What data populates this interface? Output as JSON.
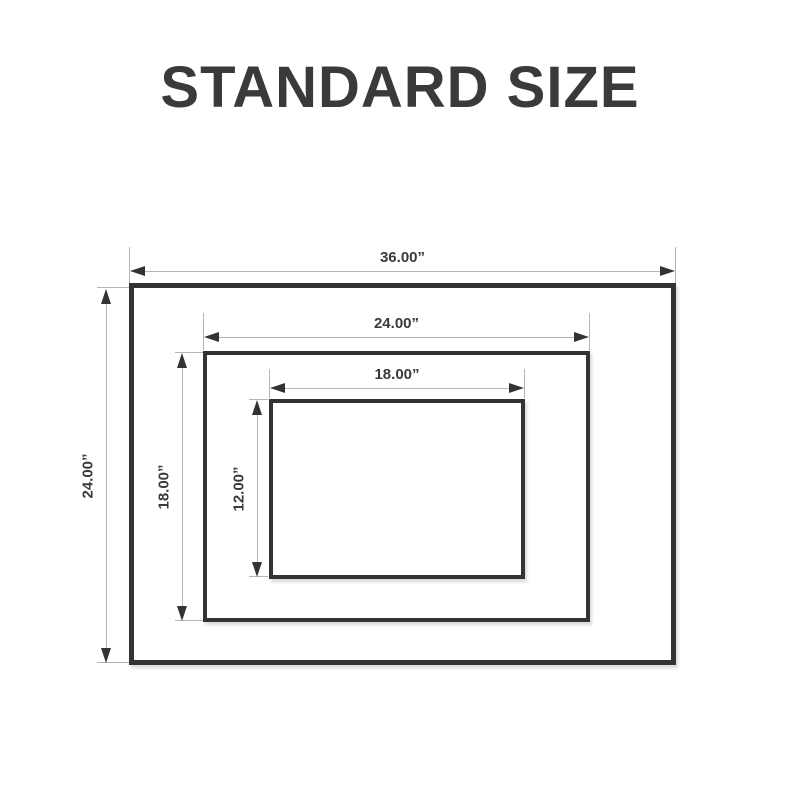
{
  "title": "STANDARD SIZE",
  "diagram": {
    "outer": {
      "width_label": "36.00”",
      "height_label": "24.00”"
    },
    "middle": {
      "width_label": "24.00”",
      "height_label": "18.00”"
    },
    "inner": {
      "width_label": "18.00”",
      "height_label": "12.00”"
    }
  },
  "colors": {
    "ink": "#333333",
    "guide": "#b5b5b5",
    "title": "#3a3a3a",
    "background": "#ffffff"
  }
}
